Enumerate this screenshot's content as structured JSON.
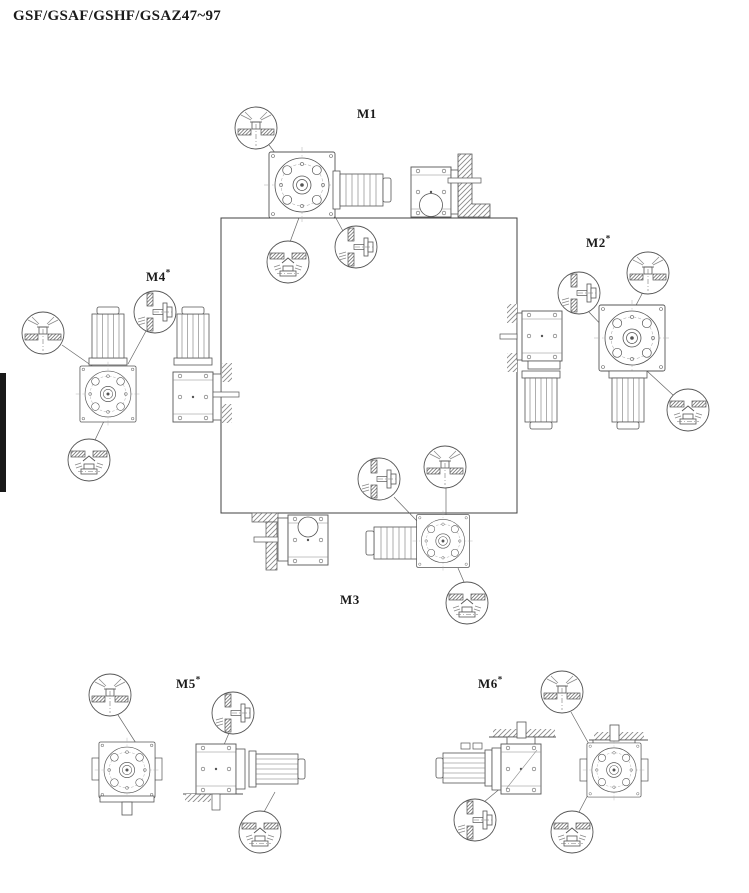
{
  "page": {
    "title": "GSF/GSAF/GSHF/GSAZ47~97"
  },
  "mounting_positions": {
    "m1": {
      "label": "M1",
      "sup": ""
    },
    "m2": {
      "label": "M2",
      "sup": "*"
    },
    "m3": {
      "label": "M3",
      "sup": ""
    },
    "m4": {
      "label": "M4",
      "sup": "*"
    },
    "m5": {
      "label": "M5",
      "sup": "*"
    },
    "m6": {
      "label": "M6",
      "sup": "*"
    }
  },
  "symbols": {
    "breather": "breather-plug",
    "oil_level": "oil-level-plug",
    "oil_drain": "oil-drain-plug"
  },
  "colors": {
    "line": "#555555",
    "square": "#404040",
    "text": "#1b1b1b",
    "edge_tab": "#191919",
    "background": "#ffffff"
  }
}
